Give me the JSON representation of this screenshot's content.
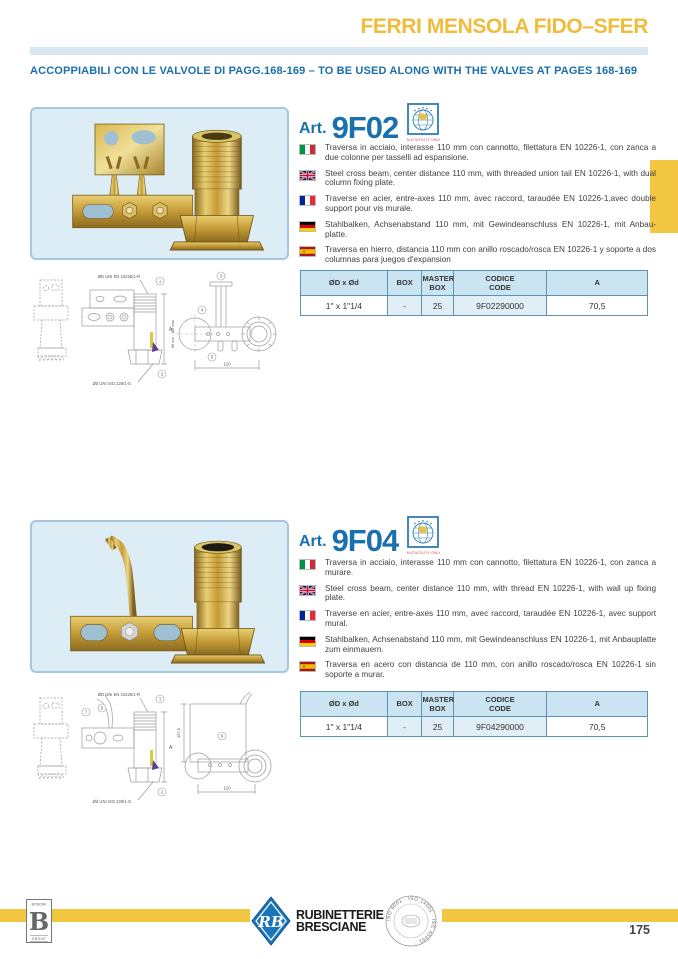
{
  "page": {
    "title": "FERRI MENSOLA FIDO–SFER",
    "subtitle": "ACCOPPIABILI CON LE VALVOLE DI PAGG.168-169 – TO BE USED ALONG WITH THE VALVES AT PAGES 168-169",
    "page_number": "175"
  },
  "cert_logo": {
    "caption": "MULTIUTILITY ONLY"
  },
  "sections": [
    {
      "art_prefix": "Art.",
      "art_code": "9F02",
      "descriptions": [
        {
          "lang": "italian",
          "text": "Traversa in acciaio, interasse 110 mm con cannotto, filettatura EN 10226-1, con zanca a due colonne per tasselli ad espansione."
        },
        {
          "lang": "english",
          "text": "Steel cross beam, center distance 110 mm, with threaded union tail EN 10226-1, with dual column fixing plate."
        },
        {
          "lang": "french",
          "text": "Traverse en acier, entre-axes 110 mm, avec raccord, taraudée EN 10226-1,avec double support pour vis murale."
        },
        {
          "lang": "german",
          "text": "Stahlbalken, Achsenabstand 110 mm, mit Gewindeanschluss EN 10226-1, mit Anbau-platte."
        },
        {
          "lang": "spanish",
          "text": "Traversa en hierro, distancia 110 mm con anillo roscado/rosca EN 10226-1 y soporte a dos columnas para juegos d'expansion"
        }
      ],
      "table": {
        "headers": [
          "ØD x Ød",
          "BOX",
          "MASTER\nBOX",
          "CODICE\nCODE",
          "A"
        ],
        "row": [
          "1\" x 1\"1/4",
          "-",
          "25",
          "9F02290000",
          "70,5"
        ]
      },
      "drawing": {
        "thread_top_label": "ØD UNI EN 10226/1-R",
        "thread_bottom_label": "Ød UNI ISO 228/1-G",
        "dim_a_label": "A",
        "range_label": "85 min - 180 max",
        "center_distance_label": "110",
        "markers": {
          "m1": "1",
          "m2": "2",
          "m3": "3",
          "m4": "4",
          "m5": "5"
        }
      }
    },
    {
      "art_prefix": "Art.",
      "art_code": "9F04",
      "descriptions": [
        {
          "lang": "italian",
          "text": "Traversa in acciaio, interasse 110 mm con cannotto, filettatura EN 10226-1, con zanca a murare."
        },
        {
          "lang": "english",
          "text": "Steel cross beam, center distance 110 mm, with thread EN 10226-1, with wall up fixing plate."
        },
        {
          "lang": "french",
          "text": "Traverse en acier, entre-axes 110 mm, avec raccord, taraudée EN 10226-1, avec support mural."
        },
        {
          "lang": "german",
          "text": "Stahlbalken, Achsenabstand 110 mm, mit Gewindeanschluss EN 10226-1, mit Anbauplatte zum einmauern."
        },
        {
          "lang": "spanish",
          "text": "Traversa en acero con distancia de 110 mm, con anillo roscado/rosca EN 10226-1 sin soporte a murar."
        }
      ],
      "table": {
        "headers": [
          "ØD x Ød",
          "BOX",
          "MASTER\nBOX",
          "CODICE\nCODE",
          "A"
        ],
        "row": [
          "1\" x 1\"1/4",
          "-",
          "25",
          "9F04290000",
          "70,5"
        ]
      },
      "drawing": {
        "thread_top_label": "ØD UNI EN 10226/1-R",
        "thread_bottom_label": "Ød UNI ISO 228/1-G",
        "dim_a_label": "A",
        "height_label": "157,5",
        "center_distance_label": "110",
        "markers": {
          "m1": "1",
          "m2": "2",
          "m5": "5",
          "m6": "6",
          "m7": "7"
        }
      }
    }
  ],
  "footer": {
    "group_logo": {
      "top": "BONOMI",
      "letter": "B",
      "bottom": "GROUP"
    },
    "brand": {
      "monogram": "RB",
      "name_line1": "RUBINETTERIE",
      "name_line2": "BRESCIANE"
    },
    "iso_text": "ISO 9001 · ISO 14001 · ISO 45001 · "
  }
}
